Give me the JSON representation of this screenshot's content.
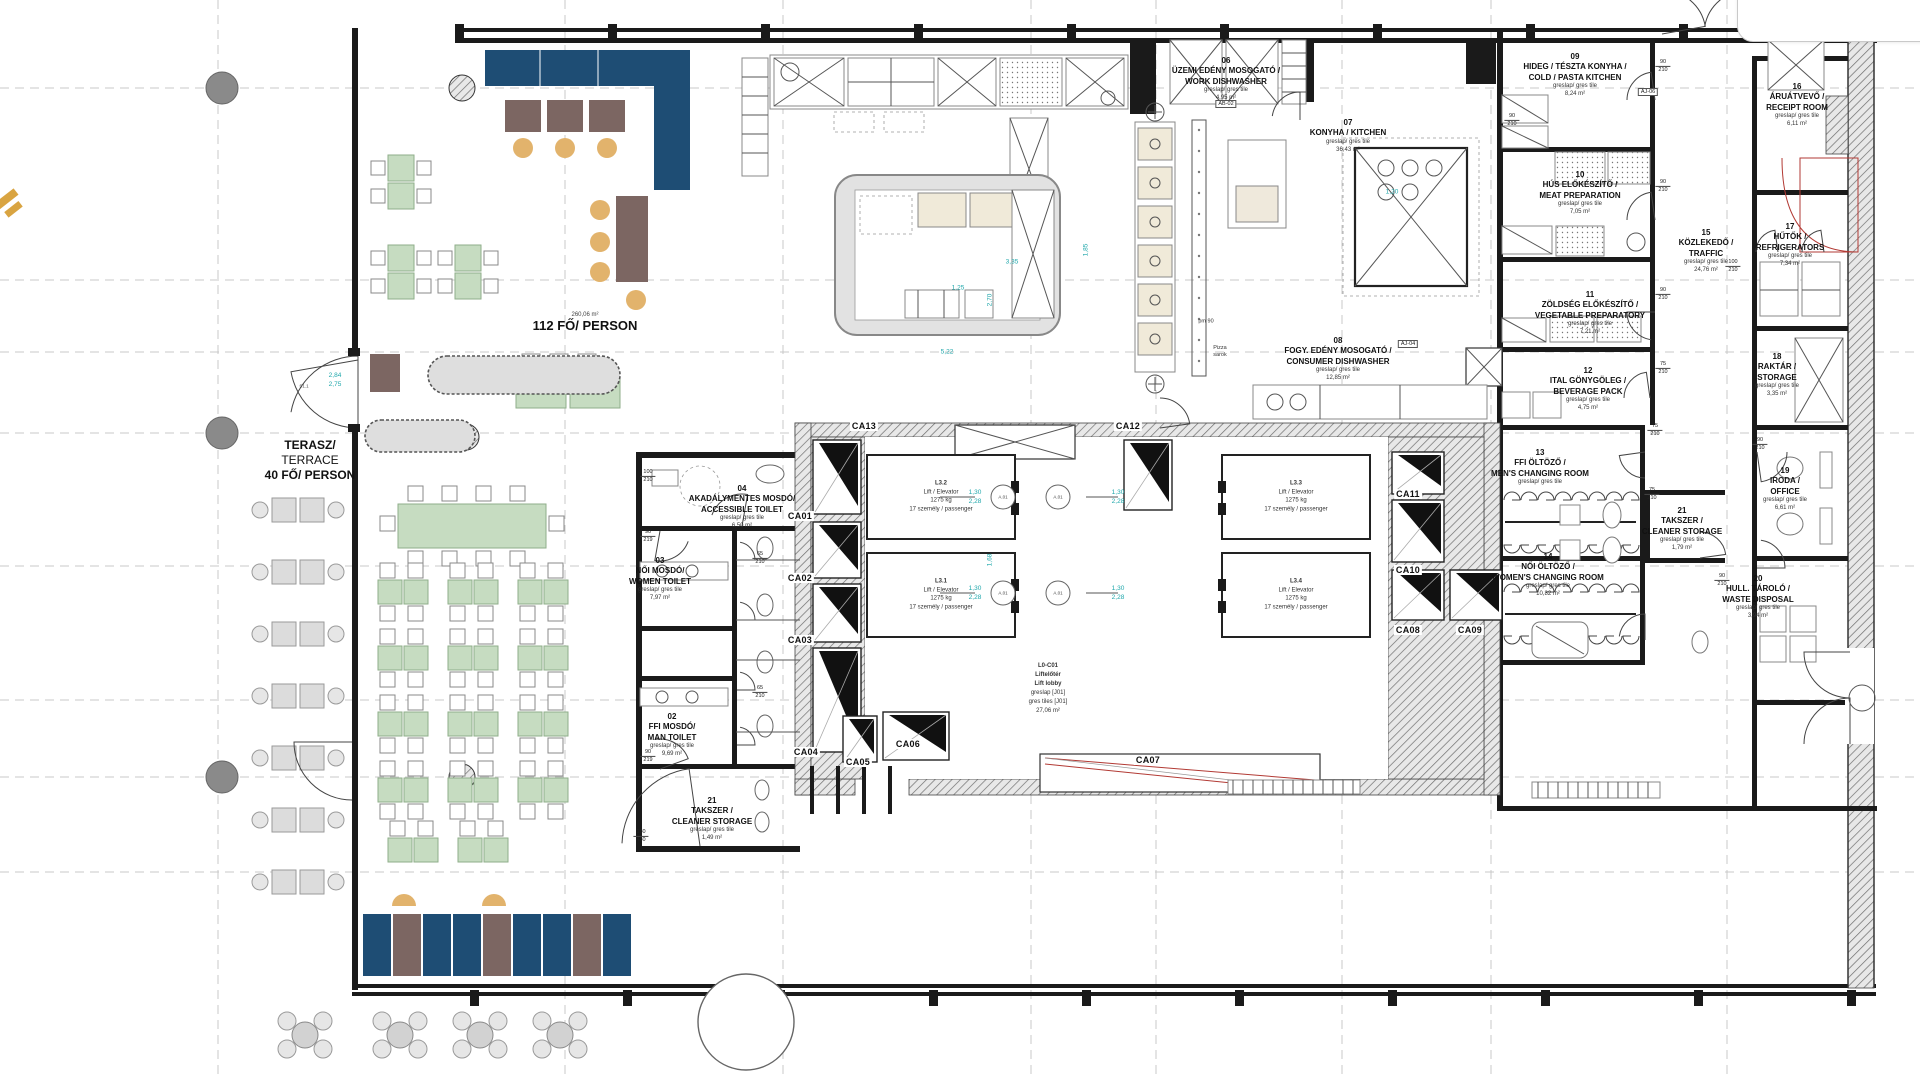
{
  "colors": {
    "navy": "#1e4d74",
    "green": "#c6dcc1",
    "tan": "#e2b36c",
    "brown": "#7c6662",
    "gray_furniture": "#dcdcdc",
    "wall": "#1a1a1a",
    "cyan_dim": "#1fa7ab",
    "red_accent": "#b23a34",
    "gold_mark": "#d9a441",
    "grid_marker": "#8a8a8a"
  },
  "tile_note": "greslap/ gres tile",
  "capacity": {
    "dining_note": "260,06 m²",
    "dining": "112 FŐ/ PERSON",
    "terrace_lines": [
      "TERASZ/",
      "TERRACE",
      "40 FŐ/ PERSON"
    ]
  },
  "rooms": [
    {
      "key": "02",
      "id": "02",
      "hu": "FFI MOSDÓ/",
      "en": "MAN TOILET",
      "area": "9,69 m²",
      "x": 672,
      "y": 712
    },
    {
      "key": "03",
      "id": "03",
      "hu": "NŐI MOSDÓ/",
      "en": "WOMEN TOILET",
      "area": "7,97 m²",
      "x": 660,
      "y": 556
    },
    {
      "key": "04",
      "id": "04",
      "hu": "AKADÁLYMENTES MOSDÓ/",
      "en": "ACCESSIBLE TOILET",
      "area": "6,50 m²",
      "x": 742,
      "y": 484
    },
    {
      "key": "06",
      "id": "06",
      "hu": "ÜZEMI EDÉNY MOSOGATÓ /",
      "en": "WORK DISHWASHER",
      "area": "4,95 m²",
      "x": 1226,
      "y": 56
    },
    {
      "key": "07",
      "id": "07",
      "hu": "KONYHA / KITCHEN",
      "en": "",
      "area": "36,43 m²",
      "x": 1348,
      "y": 118
    },
    {
      "key": "08",
      "id": "08",
      "hu": "FOGY. EDÉNY MOSOGATÓ /",
      "en": "CONSUMER DISHWASHER",
      "area": "12,85 m²",
      "x": 1338,
      "y": 336
    },
    {
      "key": "09",
      "id": "09",
      "hu": "HIDEG / TÉSZTA KONYHA /",
      "en": "COLD / PASTA KITCHEN",
      "area": "8,24 m²",
      "x": 1575,
      "y": 52
    },
    {
      "key": "10",
      "id": "10",
      "hu": "HÚS ELŐKÉSZÍTŐ /",
      "en": "MEAT PREPARATION",
      "area": "7,05 m²",
      "x": 1580,
      "y": 170
    },
    {
      "key": "11",
      "id": "11",
      "hu": "ZÖLDSÉG ELŐKÉSZÍTŐ /",
      "en": "VEGETABLE PREPARATORY",
      "area": "7,21 m²",
      "x": 1590,
      "y": 290
    },
    {
      "key": "12",
      "id": "12",
      "hu": "ITAL GÖNYGÖLEG /",
      "en": "BEVERAGE PACK",
      "area": "4,75 m²",
      "x": 1588,
      "y": 366
    },
    {
      "key": "13",
      "id": "13",
      "hu": "FFI ÖLTÖZŐ /",
      "en": "MEN'S CHANGING ROOM",
      "area": "",
      "x": 1540,
      "y": 448
    },
    {
      "key": "14",
      "id": "14",
      "hu": "NŐI ÖLTÖZŐ /",
      "en": "WOMEN'S CHANGING ROOM",
      "area": "10,82 m²",
      "x": 1548,
      "y": 552
    },
    {
      "key": "15",
      "id": "15",
      "hu": "KÖZLEKEDŐ /",
      "en": "TRAFFIC",
      "area": "24,76 m²",
      "x": 1706,
      "y": 228
    },
    {
      "key": "16",
      "id": "16",
      "hu": "ÁRUÁTVEVŐ /",
      "en": "RECEIPT ROOM",
      "area": "6,11 m²",
      "x": 1797,
      "y": 82
    },
    {
      "key": "17",
      "id": "17",
      "hu": "HŰTŐK /",
      "en": "REFRIGERATORS",
      "area": "7,34 m²",
      "x": 1790,
      "y": 222
    },
    {
      "key": "18",
      "id": "18",
      "hu": "RAKTÁR /",
      "en": "STORAGE",
      "area": "3,35 m²",
      "x": 1777,
      "y": 352
    },
    {
      "key": "19",
      "id": "19",
      "hu": "IRODA /",
      "en": "OFFICE",
      "area": "6,61 m²",
      "x": 1785,
      "y": 466
    },
    {
      "key": "20",
      "id": "20",
      "hu": "HULL. TÁROLÓ /",
      "en": "WASTE DISPOSAL",
      "area": "3,94 m²",
      "x": 1758,
      "y": 574
    },
    {
      "key": "21a",
      "id": "21",
      "hu": "TAKSZER /",
      "en": "CLEANER STORAGE",
      "area": "1,49 m²",
      "x": 712,
      "y": 796
    },
    {
      "key": "21b",
      "id": "21",
      "hu": "TAKSZER /",
      "en": "CLEANER STORAGE",
      "area": "1,79 m²",
      "x": 1682,
      "y": 506
    }
  ],
  "lobby": {
    "lines": [
      "L0-C01",
      "Liftelőtér",
      "Lift lobby",
      "greslap [J01]",
      "gres tiles [J01]",
      "27,06 m²"
    ],
    "x": 1048,
    "y": 662
  },
  "elevator_spec": [
    "Lift / Elevator",
    "1275 kg",
    "17 személy / passenger"
  ],
  "elevators": [
    {
      "id": "L3.2",
      "x": 941,
      "y": 497
    },
    {
      "id": "L3.1",
      "x": 941,
      "y": 595
    },
    {
      "id": "L3.3",
      "x": 1296,
      "y": 497
    },
    {
      "id": "L3.4",
      "x": 1296,
      "y": 595
    }
  ],
  "shafts": [
    {
      "id": "CA01",
      "x": 800,
      "y": 516
    },
    {
      "id": "CA02",
      "x": 800,
      "y": 578
    },
    {
      "id": "CA03",
      "x": 800,
      "y": 640
    },
    {
      "id": "CA04",
      "x": 806,
      "y": 752
    },
    {
      "id": "CA05",
      "x": 858,
      "y": 762
    },
    {
      "id": "CA06",
      "x": 908,
      "y": 744
    },
    {
      "id": "CA07",
      "x": 1148,
      "y": 760
    },
    {
      "id": "CA08",
      "x": 1408,
      "y": 630
    },
    {
      "id": "CA09",
      "x": 1470,
      "y": 630
    },
    {
      "id": "CA10",
      "x": 1408,
      "y": 570
    },
    {
      "id": "CA11",
      "x": 1408,
      "y": 494
    },
    {
      "id": "CA12",
      "x": 1128,
      "y": 426
    },
    {
      "id": "CA13",
      "x": 864,
      "y": 426
    }
  ],
  "door_circle_label": "A.01",
  "dim_tags": [
    {
      "a": "90",
      "b": "219",
      "x": 648,
      "y": 536
    },
    {
      "a": "90",
      "b": "219",
      "x": 648,
      "y": 756
    },
    {
      "a": "180",
      "b": "430",
      "x": 641,
      "y": 836
    },
    {
      "a": "65",
      "b": "210",
      "x": 760,
      "y": 558
    },
    {
      "a": "65",
      "b": "210",
      "x": 760,
      "y": 692
    },
    {
      "a": "90",
      "b": "210",
      "x": 1663,
      "y": 66
    },
    {
      "a": "90",
      "b": "210",
      "x": 1663,
      "y": 186
    },
    {
      "a": "90",
      "b": "210",
      "x": 1663,
      "y": 294
    },
    {
      "a": "75",
      "b": "210",
      "x": 1663,
      "y": 368
    },
    {
      "a": "75",
      "b": "210",
      "x": 1655,
      "y": 430
    },
    {
      "a": "75",
      "b": "210",
      "x": 1652,
      "y": 494
    },
    {
      "a": "100",
      "b": "210",
      "x": 1733,
      "y": 266
    },
    {
      "a": "90",
      "b": "210",
      "x": 1760,
      "y": 444
    },
    {
      "a": "90",
      "b": "210",
      "x": 1722,
      "y": 580
    },
    {
      "a": "100",
      "b": "210",
      "x": 648,
      "y": 476
    },
    {
      "a": "90",
      "b": "210",
      "x": 1512,
      "y": 120
    }
  ],
  "annotations": [
    {
      "t": "AB-02",
      "x": 1226,
      "y": 104,
      "cls": "tagbox"
    },
    {
      "t": "AJ-04",
      "x": 1408,
      "y": 344,
      "cls": "tagbox"
    },
    {
      "t": "AJ-06",
      "x": 1648,
      "y": 92,
      "cls": "tagbox"
    },
    {
      "t": "pm 90",
      "x": 1206,
      "y": 322,
      "cls": "tiny"
    },
    {
      "t": "Pizza\nsarok",
      "x": 1220,
      "y": 352,
      "cls": "tiny"
    },
    {
      "t": "S1.1",
      "x": 304,
      "y": 386,
      "cls": "atag"
    }
  ],
  "cyan_dims": [
    {
      "t": "5,22",
      "x": 947,
      "y": 352,
      "rot": false
    },
    {
      "t": "1,85",
      "x": 1086,
      "y": 250,
      "rot": true
    },
    {
      "t": "3,35",
      "x": 1012,
      "y": 262,
      "rot": false
    },
    {
      "t": "1,20",
      "x": 1392,
      "y": 192,
      "rot": false
    },
    {
      "t": "2,70",
      "x": 990,
      "y": 300,
      "rot": true
    },
    {
      "t": "1,25",
      "x": 958,
      "y": 288,
      "rot": false
    },
    {
      "t": "1,68",
      "x": 990,
      "y": 560,
      "rot": true
    },
    {
      "t": "2,84\n2,75",
      "x": 335,
      "y": 380,
      "rot": false
    },
    {
      "t": "1,30\n2,28",
      "x": 975,
      "y": 497,
      "rot": false
    },
    {
      "t": "1,30\n2,28",
      "x": 1118,
      "y": 497,
      "rot": false
    },
    {
      "t": "1,30\n2,28",
      "x": 975,
      "y": 593,
      "rot": false
    },
    {
      "t": "1,30\n2,28",
      "x": 1118,
      "y": 593,
      "rot": false
    }
  ]
}
